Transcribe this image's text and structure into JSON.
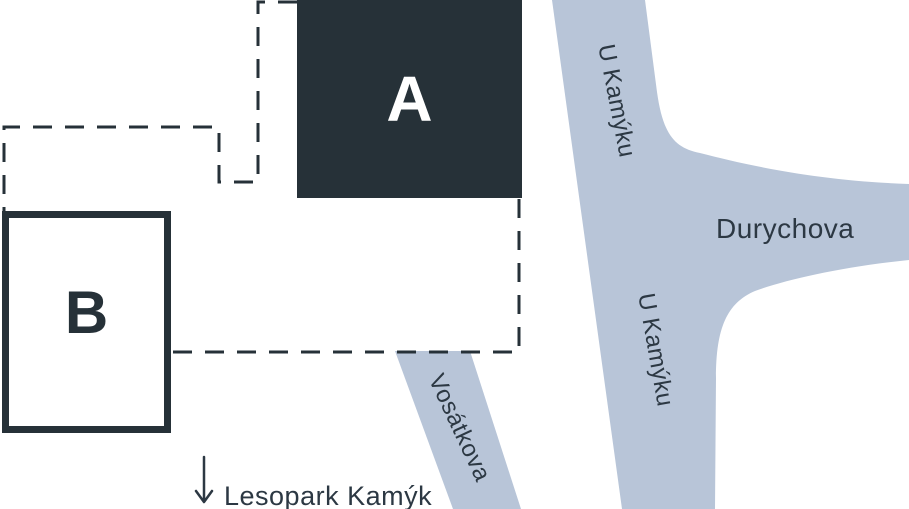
{
  "map": {
    "buildings": [
      {
        "id": "A",
        "label": "A"
      },
      {
        "id": "B",
        "label": "B"
      }
    ],
    "street_labels": {
      "u_kamyku_upper": "U Kamýku",
      "u_kamyku_lower": "U Kamýku",
      "durychova": "Durychova",
      "vosatkova": "Vosátkova"
    },
    "annotation": {
      "lesopark": "Lesopark Kamýk",
      "arrow_icon": "down-arrow"
    },
    "colors": {
      "building_fill": "#263138",
      "building_a_text": "#ffffff",
      "street_fill": "#b8c5d8",
      "label_color": "#2c3843"
    }
  }
}
